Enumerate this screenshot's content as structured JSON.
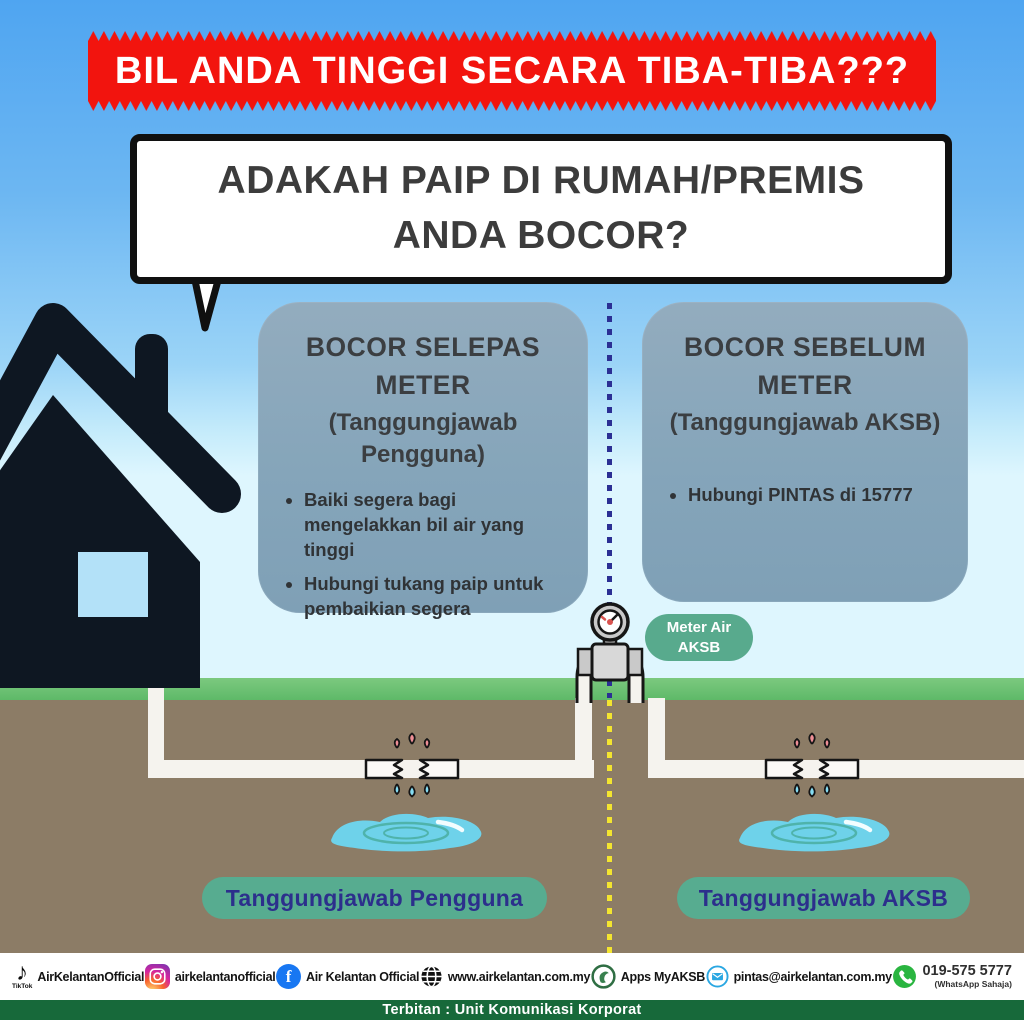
{
  "banner": {
    "text": "BIL ANDA TINGGI SECARA TIBA-TIBA???",
    "bg_color": "#f2140e"
  },
  "bubble": {
    "line1": "ADAKAH PAIP DI RUMAH/PREMIS",
    "line2": "ANDA BOCOR?"
  },
  "left_box": {
    "title": "BOCOR SELEPAS METER",
    "subtitle": "(Tanggungjawab Pengguna)",
    "bullets": [
      "Baiki segera bagi mengelakkan bil air yang tinggi",
      "Hubungi tukang paip untuk pembaikian segera"
    ]
  },
  "right_box": {
    "title": "BOCOR SEBELUM METER",
    "subtitle": "(Tanggungjawab AKSB)",
    "bullets": [
      "Hubungi PINTAS di 15777"
    ]
  },
  "meter_badge": {
    "line1": "Meter Air",
    "line2": "AKSB"
  },
  "zone_labels": {
    "left": "Tanggungjawab Pengguna",
    "right": "Tanggungjawab AKSB"
  },
  "footer": {
    "tiktok_mini": "TikTok",
    "tiktok_handle": "AirKelantanOfficial",
    "instagram_handle": "airkelantanofficial",
    "facebook_name": "Air Kelantan Official",
    "website": "www.airkelantan.com.my",
    "app": "Apps MyAKSB",
    "email": "pintas@airkelantan.com.my",
    "whatsapp_number": "019-575 5777",
    "whatsapp_note": "(WhatsApp Sahaja)"
  },
  "bottom_bar": {
    "text": "Terbitan : Unit Komunikasi Korporat"
  },
  "colors": {
    "banner_red": "#f2140e",
    "box_bluegray": "#85a5ba",
    "badge_green": "#57ac90",
    "badge_text_indigo": "#2c2f8c",
    "grass": "#5eb968",
    "soil": "#8c7c66",
    "dash_blue": "#2b2f94",
    "dash_yellow": "#f4e52f",
    "footer_bar_green": "#17693a"
  }
}
